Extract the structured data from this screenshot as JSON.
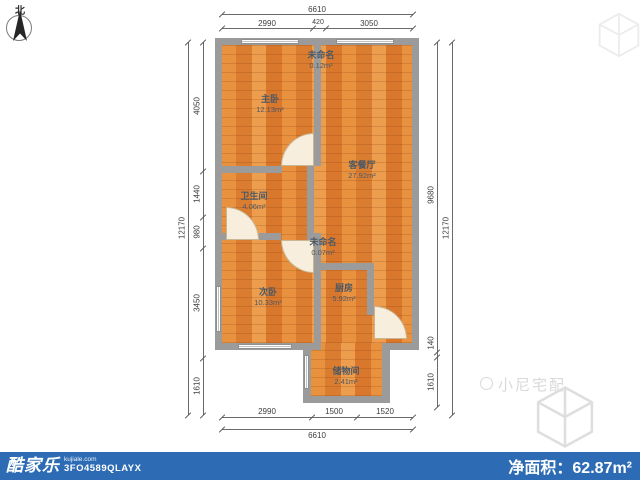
{
  "compass": {
    "north_label": "北"
  },
  "rooms": [
    {
      "id": "unnamed-top",
      "name": "未命名",
      "area": "0.12m²"
    },
    {
      "id": "master-bedroom",
      "name": "主卧",
      "area": "12.13m²"
    },
    {
      "id": "living-dining",
      "name": "客餐厅",
      "area": "27.92m²"
    },
    {
      "id": "bathroom",
      "name": "卫生间",
      "area": "4.06m²"
    },
    {
      "id": "unnamed-middle",
      "name": "未命名",
      "area": "0.07m²"
    },
    {
      "id": "second-bedroom",
      "name": "次卧",
      "area": "10.33m²"
    },
    {
      "id": "kitchen",
      "name": "厨房",
      "area": "5.92m²"
    },
    {
      "id": "storage",
      "name": "储物间",
      "area": "2.41m²"
    }
  ],
  "dimensions": {
    "top": {
      "overall": "6610",
      "segments": [
        "2990",
        "420",
        "3050"
      ]
    },
    "bottom": {
      "overall": "6610",
      "segments": [
        "2990",
        "1500",
        "1520"
      ]
    },
    "left": {
      "overall": "12170",
      "segments": [
        "4050",
        "1440",
        "980",
        "3450",
        "1610"
      ]
    },
    "right": {
      "overall": "12170",
      "segments": [
        "9680",
        "140",
        "1610"
      ]
    }
  },
  "watermark": {
    "brand": "小尼宅配"
  },
  "footer": {
    "logo": "酷家乐",
    "logo_domain": "kujiale.com",
    "code": "3FO4589QLAYX",
    "net_area_label": "净面积：",
    "net_area_value": "62.87m²"
  },
  "colors": {
    "wall": "#9b9b9b",
    "floor": "#e0863b",
    "footer_bar": "#2d6cb5",
    "label_text": "#4b5866",
    "watermark": "#d9d9d9"
  }
}
